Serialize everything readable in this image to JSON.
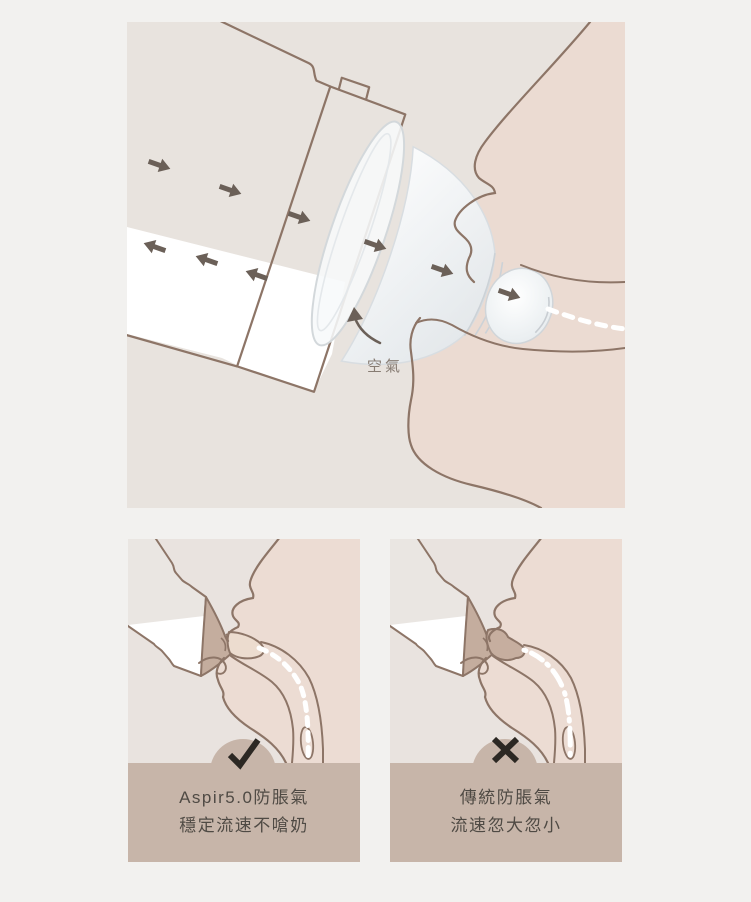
{
  "page": {
    "background": "#f2f1ef",
    "description_marks": {
      "good_mark": "check",
      "bad_mark": "cross"
    }
  },
  "colors": {
    "panel_bg": "#e8e3de",
    "face_fill": "#ebdbd2",
    "outline_brown": "#8d7567",
    "arrow": "#6b6058",
    "caption_bg": "#c7b5a9",
    "caption_text": "#4f4a44",
    "mark": "#2c2823",
    "milk": "#ffffff",
    "teat_taupe": "#c4ad9e"
  },
  "top_panel": {
    "air_label": "空氣"
  },
  "bottom_left": {
    "mark": "check",
    "line1": "Aspir5.0防脹氣",
    "line2": "穩定流速不嗆奶"
  },
  "bottom_right": {
    "mark": "cross",
    "line1": "傳統防脹氣",
    "line2": "流速忽大忽小"
  }
}
